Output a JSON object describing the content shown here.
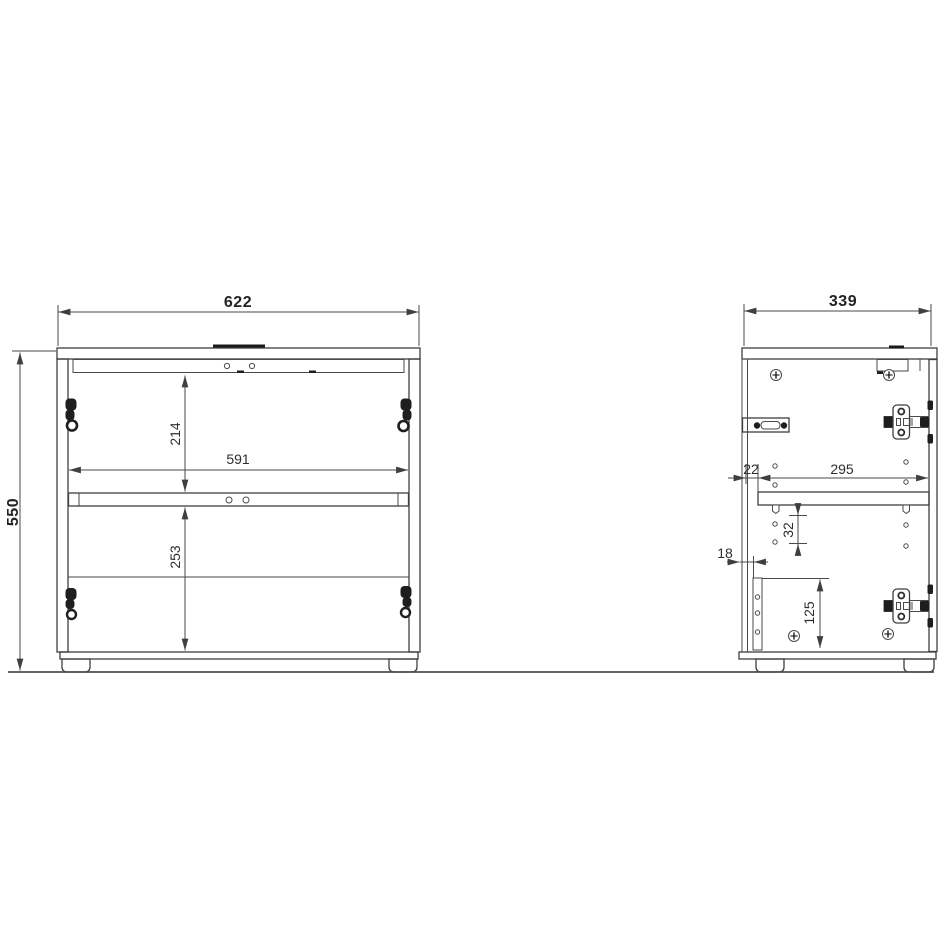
{
  "front_view": {
    "dims": {
      "overall_width": "622",
      "overall_height": "550",
      "top_opening_height": "214",
      "inner_width": "591",
      "bottom_opening_height": "253"
    }
  },
  "side_view": {
    "dims": {
      "overall_depth": "339",
      "shelf_back_offset": "22",
      "shelf_depth": "295",
      "hole_spacing": "32",
      "rail_back_offset": "18",
      "rail_height": "125"
    }
  },
  "colors": {
    "line": "#3f3f3f",
    "dimension_line": "#4a4a4a",
    "text": "#2e2e2e",
    "hardware_black": "#1e1e1e",
    "background": "#ffffff"
  }
}
